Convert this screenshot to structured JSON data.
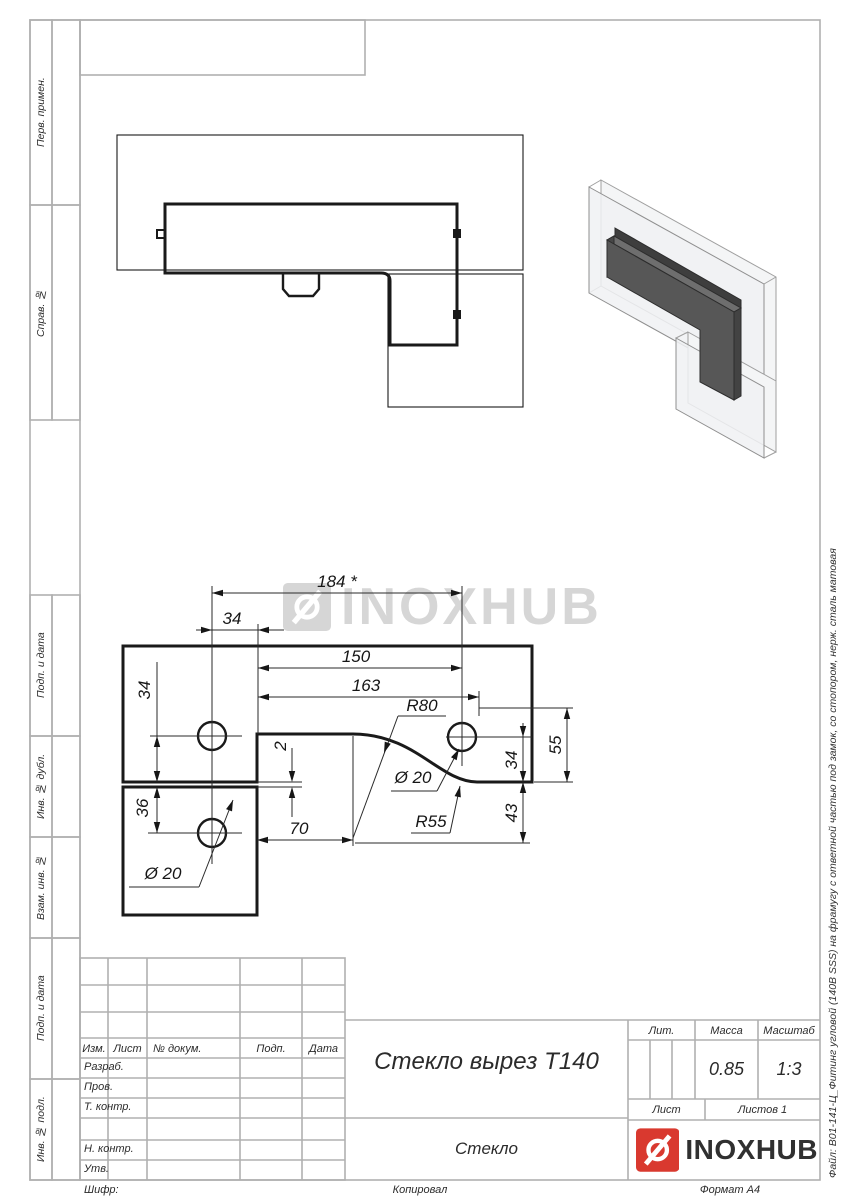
{
  "page": {
    "cipher_label": "Шифр:",
    "copied_label": "Копировал",
    "format_label": "Формат А4",
    "file_vertical_text": "Файл: В01-141-Ц_Фитинг угловой (140В SSS) на фрамугу с ответной частью под замок, со стопором, нерж. сталь матовая"
  },
  "sidebar": {
    "items": [
      {
        "label": "Перв. примен."
      },
      {
        "label": "Справ. №"
      },
      {
        "label": "Подп. и дата"
      },
      {
        "label": "Инв. № дубл."
      },
      {
        "label": "Взам. инв. №"
      },
      {
        "label": "Подп. и дата"
      },
      {
        "label": "Инв. № подл."
      }
    ]
  },
  "title_block": {
    "columns": [
      {
        "label": "Изм."
      },
      {
        "label": "Лист"
      },
      {
        "label": "№ докум."
      },
      {
        "label": "Подп."
      },
      {
        "label": "Дата"
      }
    ],
    "rows": [
      {
        "label": "Разраб."
      },
      {
        "label": "Пров."
      },
      {
        "label": "Т. контр."
      },
      {
        "label": "Н. контр."
      },
      {
        "label": "Утв."
      }
    ],
    "doc_title": "Стекло вырез Т140",
    "material": "Стекло",
    "lit_label": "Лит.",
    "mass_label": "Масса",
    "mass_value": "0.85",
    "scale_label": "Масштаб",
    "scale_value": "1:3",
    "sheet_label": "Лист",
    "sheets_label": "Листов 1",
    "brand": "INOXHUB"
  },
  "watermark": {
    "text": "INOXHUB"
  },
  "dims": {
    "d184": "184 *",
    "d34_top": "34",
    "d150": "150",
    "d163": "163",
    "r80": "R80",
    "d55": "55",
    "d34_right": "34",
    "d43": "43",
    "d2": "2",
    "d34_left": "34",
    "d36": "36",
    "d70": "70",
    "r55": "R55",
    "dia20_right": "Ø 20",
    "dia20_left": "Ø 20"
  },
  "colors": {
    "accent_red": "#d9392f",
    "frame_line": "#b0b0b0",
    "drawing_line": "#1a1a1a",
    "watermark_gray": "#d6d6d6",
    "fitting_dark": "#575757"
  }
}
